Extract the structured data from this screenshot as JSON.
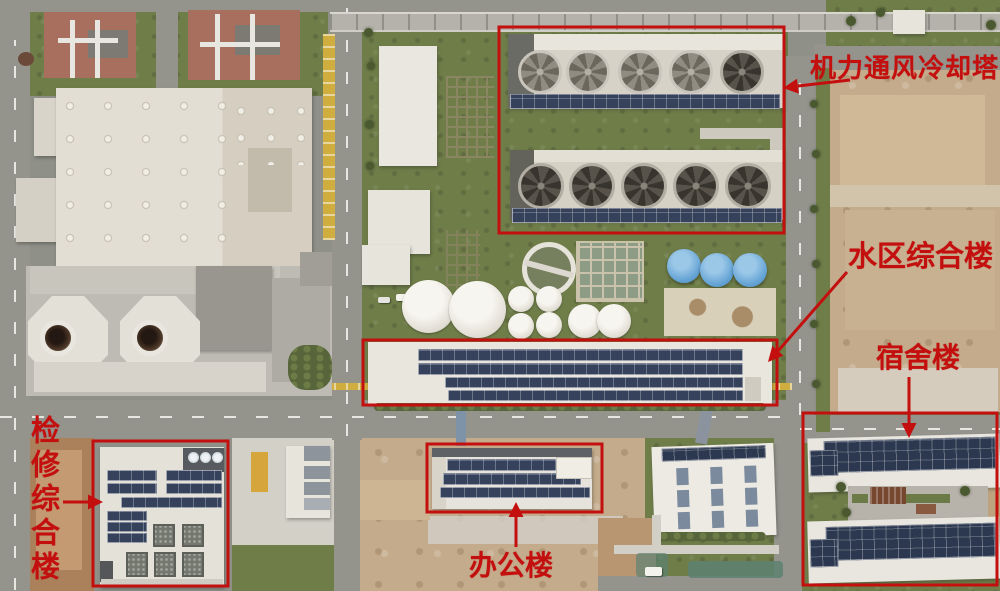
{
  "annotations": {
    "color": "#c40f0f",
    "labels": {
      "cooling_towers": "机力通风冷却塔",
      "water_area_complex": "水区综合楼",
      "dormitory": "宿舍楼",
      "maintenance_complex": "检修综合楼",
      "office": "办公楼"
    }
  }
}
